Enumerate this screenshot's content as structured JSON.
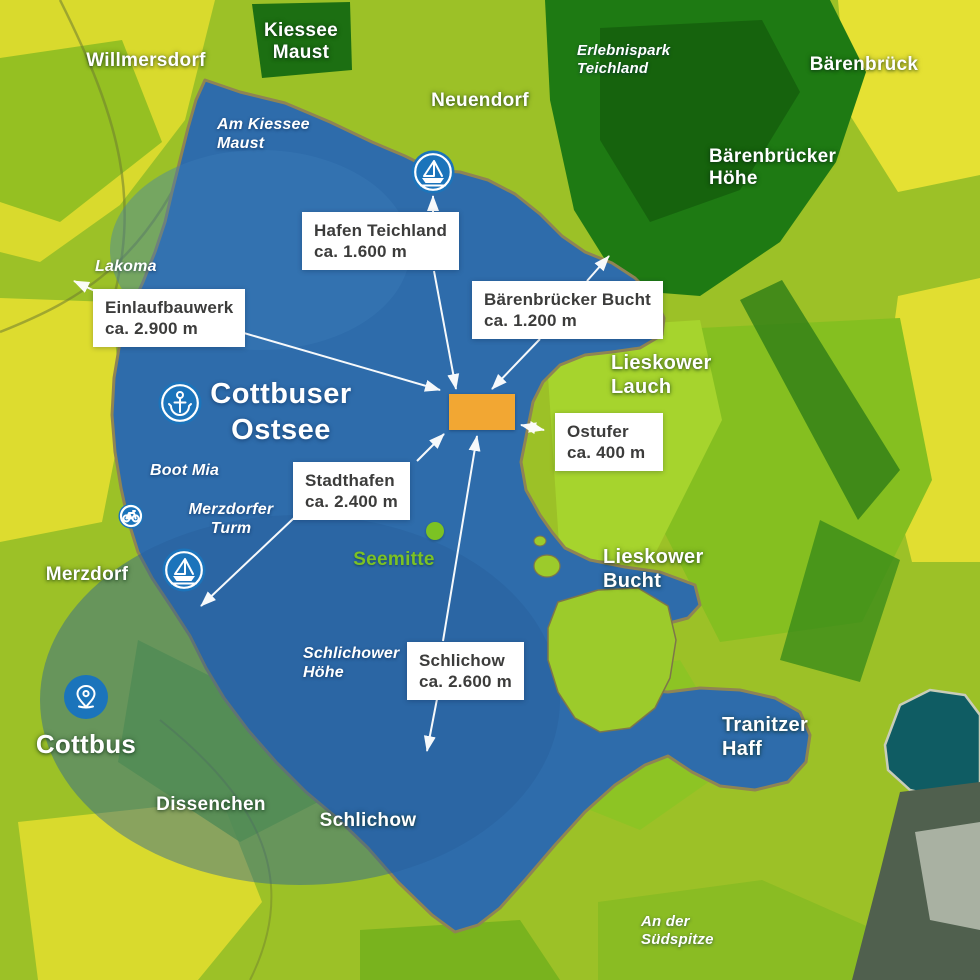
{
  "lake_title": "Cottbuser\nOstsee",
  "callouts": [
    {
      "title": "Hafen Teichland",
      "distance": "ca. 1.600 m"
    },
    {
      "title": "Einlaufbauwerk",
      "distance": "ca. 2.900 m"
    },
    {
      "title": "Bärenbrücker Bucht",
      "distance": "ca. 1.200 m"
    },
    {
      "title": "Ostufer",
      "distance": "ca. 400 m"
    },
    {
      "title": "Stadthafen",
      "distance": "ca. 2.400 m"
    },
    {
      "title": "Schlichow",
      "distance": "ca. 2.600 m"
    }
  ],
  "places": [
    {
      "name": "Willmersdorf"
    },
    {
      "name": "Kiessee\nMaust"
    },
    {
      "name": "Neuendorf"
    },
    {
      "name": "Bärenbrück"
    },
    {
      "name": "Bärenbrücker\nHöhe"
    },
    {
      "name": "Merzdorf"
    },
    {
      "name": "Cottbus"
    },
    {
      "name": "Dissenchen"
    },
    {
      "name": "Schlichow"
    },
    {
      "name": "Lieskower\nLauch"
    },
    {
      "name": "Lieskower\nBucht"
    },
    {
      "name": "Tranitzer\nHaff"
    }
  ],
  "water_labels": [
    {
      "name": "Am Kiessee\nMaust"
    },
    {
      "name": "Erlebnispark\nTeichland"
    },
    {
      "name": "Lakoma"
    },
    {
      "name": "Boot Mia"
    },
    {
      "name": "Merzdorfer\nTurm"
    },
    {
      "name": "Schlichower\nHöhe"
    },
    {
      "name": "An der\nSüdspitze"
    }
  ],
  "seemitte": {
    "label": "Seemitte"
  },
  "icons": {
    "harbor_maust": "sailboat-icon",
    "harbor_merzdorf": "sailboat-icon",
    "lake_center_badge": "anchor-icon",
    "bike_route": "bicycle-icon",
    "cottbus_marker": "location-pin-icon",
    "seemitte_marker": "green-dot"
  },
  "colors": {
    "water": "#2E6CAB",
    "marker_orange": "#F2A733",
    "icon_blue": "#1B74BB",
    "seemitte_green": "#7CC223",
    "callout_text": "#3C3C3B"
  }
}
